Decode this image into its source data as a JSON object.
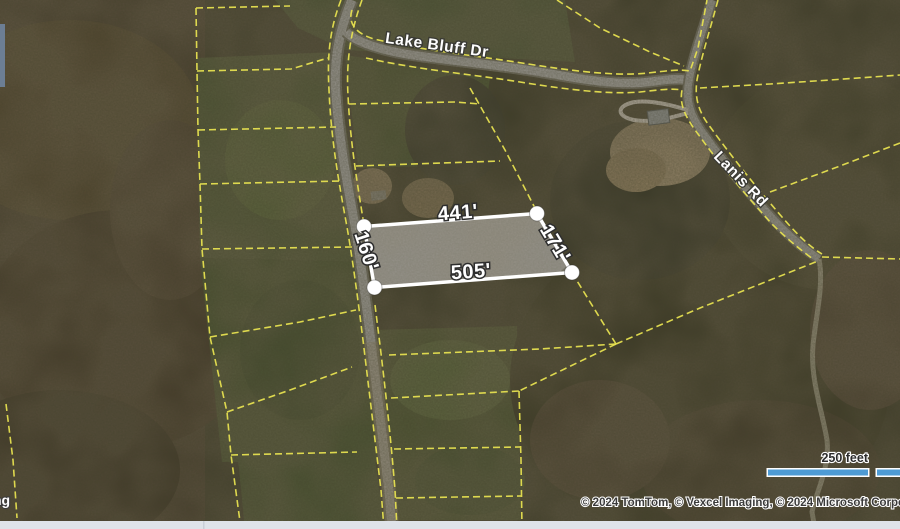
{
  "map": {
    "roads": [
      {
        "id": "lake-bluff-dr",
        "label": "Lake Bluff Dr"
      },
      {
        "id": "lanis-rd",
        "label": "Lanis Rd"
      }
    ],
    "parcel": {
      "dimensions": [
        {
          "side": "top",
          "label": "441'"
        },
        {
          "side": "right",
          "label": "171'"
        },
        {
          "side": "bottom",
          "label": "505'"
        },
        {
          "side": "left",
          "label": "160'"
        }
      ],
      "outline_color": "#ffffff",
      "fill": "rgba(255,255,255,0.27)"
    },
    "boundary_line_color": "#e6e050",
    "terrain_colors": {
      "forest_dark": "#3c3a28",
      "forest_brown": "#473e2e",
      "field_green": "#4c5433",
      "road_gray": "#94918a",
      "dirt_tan": "#97876a"
    }
  },
  "scale_bar": {
    "label": "250 feet",
    "bar_color": "#4e9bd4"
  },
  "attribution": {
    "text": "© 2024 TomTom, © Vexcel Imaging, © 2024 Microsoft Corporation"
  },
  "watermark": {
    "fragment": "ng"
  }
}
